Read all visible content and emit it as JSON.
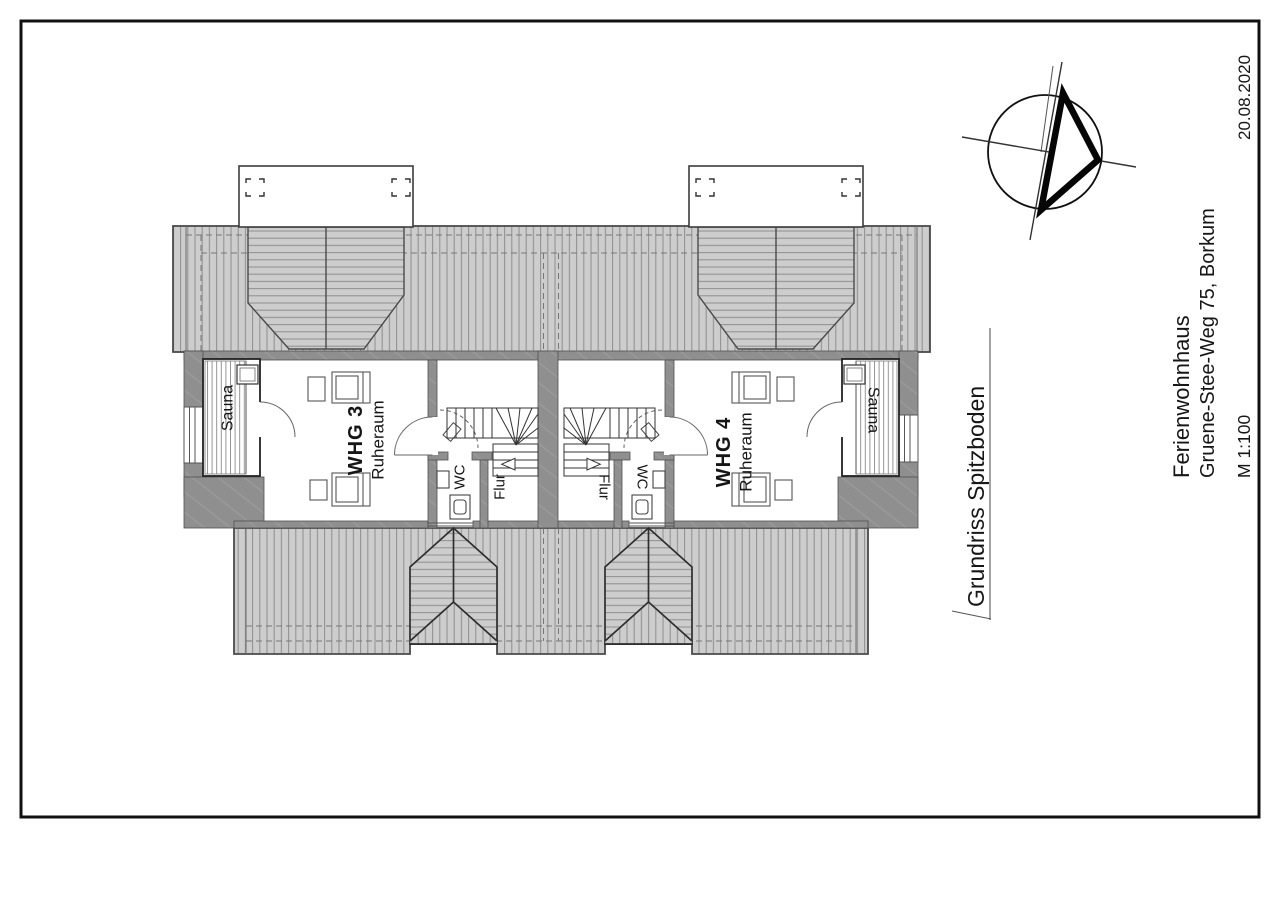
{
  "drawing": {
    "date": "20.08.2020",
    "project": "Ferienwohnhaus",
    "address": "Gruene-Stee-Weg 75, Borkum",
    "scale": "M 1:100",
    "title": "Grundriss Spitzboden"
  },
  "apartments": {
    "whg3": {
      "name": "WHG 3",
      "room": "Ruheraum",
      "sauna": "Sauna",
      "wc": "WC",
      "hall": "Flur"
    },
    "whg4": {
      "name": "WHG 4",
      "room": "Ruheraum",
      "sauna": "Sauna",
      "wc": "WC",
      "hall": "Flur"
    }
  },
  "icons": {
    "north_arrow": "north-arrow-compass"
  },
  "colors": {
    "roof_fill": "#cdcdcd",
    "roof_hatch_line": "#8e8e8e",
    "wall_fill": "#8f8f8f",
    "outline": "#3c3c3c",
    "ink": "#161616"
  }
}
